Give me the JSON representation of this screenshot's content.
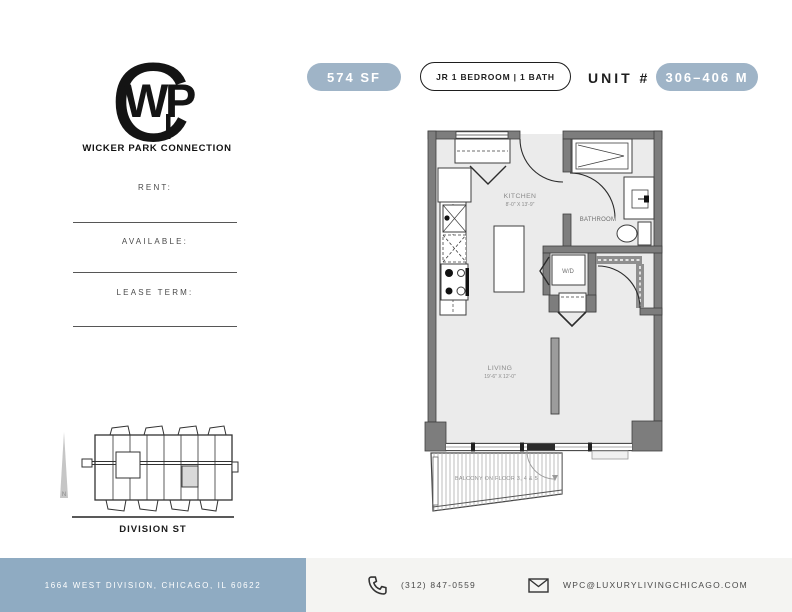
{
  "header": {
    "sqft_badge": "574 SF",
    "type_badge": "JR 1 BEDROOM | 1 BATH",
    "unit_label": "UNIT #",
    "unit_badge": "306–406 M"
  },
  "brand": {
    "monogram": {
      "c": "C",
      "w": "W",
      "p": "P"
    },
    "name": "WICKER PARK CONNECTION"
  },
  "lease_fields": [
    {
      "label": "RENT:",
      "value": ""
    },
    {
      "label": "AVAILABLE:",
      "value": ""
    },
    {
      "label": "LEASE TERM:",
      "value": ""
    }
  ],
  "site_map": {
    "street_label": "DIVISION ST",
    "north_label": "N"
  },
  "floor_plan": {
    "kitchen": {
      "name": "KITCHEN",
      "dims": "8'-0\" X 13'-9\""
    },
    "living": {
      "name": "LIVING",
      "dims": "19'-6\" X 12'-0\""
    },
    "bathroom": {
      "name": "BATHROOM"
    },
    "wd": "W/D",
    "balcony": "BALCONY ON FLOOR 3, 4 & 5"
  },
  "footer": {
    "address": "1664 WEST DIVISION, CHICAGO, IL 60622",
    "phone": "(312) 847-0559",
    "email": "WPC@LUXURYLIVINGCHICAGO.COM"
  },
  "theme": {
    "badge": "#9fb4c7",
    "footer_bar": "#8fabc2",
    "footer_bg": "#f4f4f2",
    "wall": "#7d7d7d",
    "floor": "#ebebeb",
    "highlight": "#d9d9d9",
    "ink": "#1e1e1e",
    "muted": "#8a8a8a"
  }
}
